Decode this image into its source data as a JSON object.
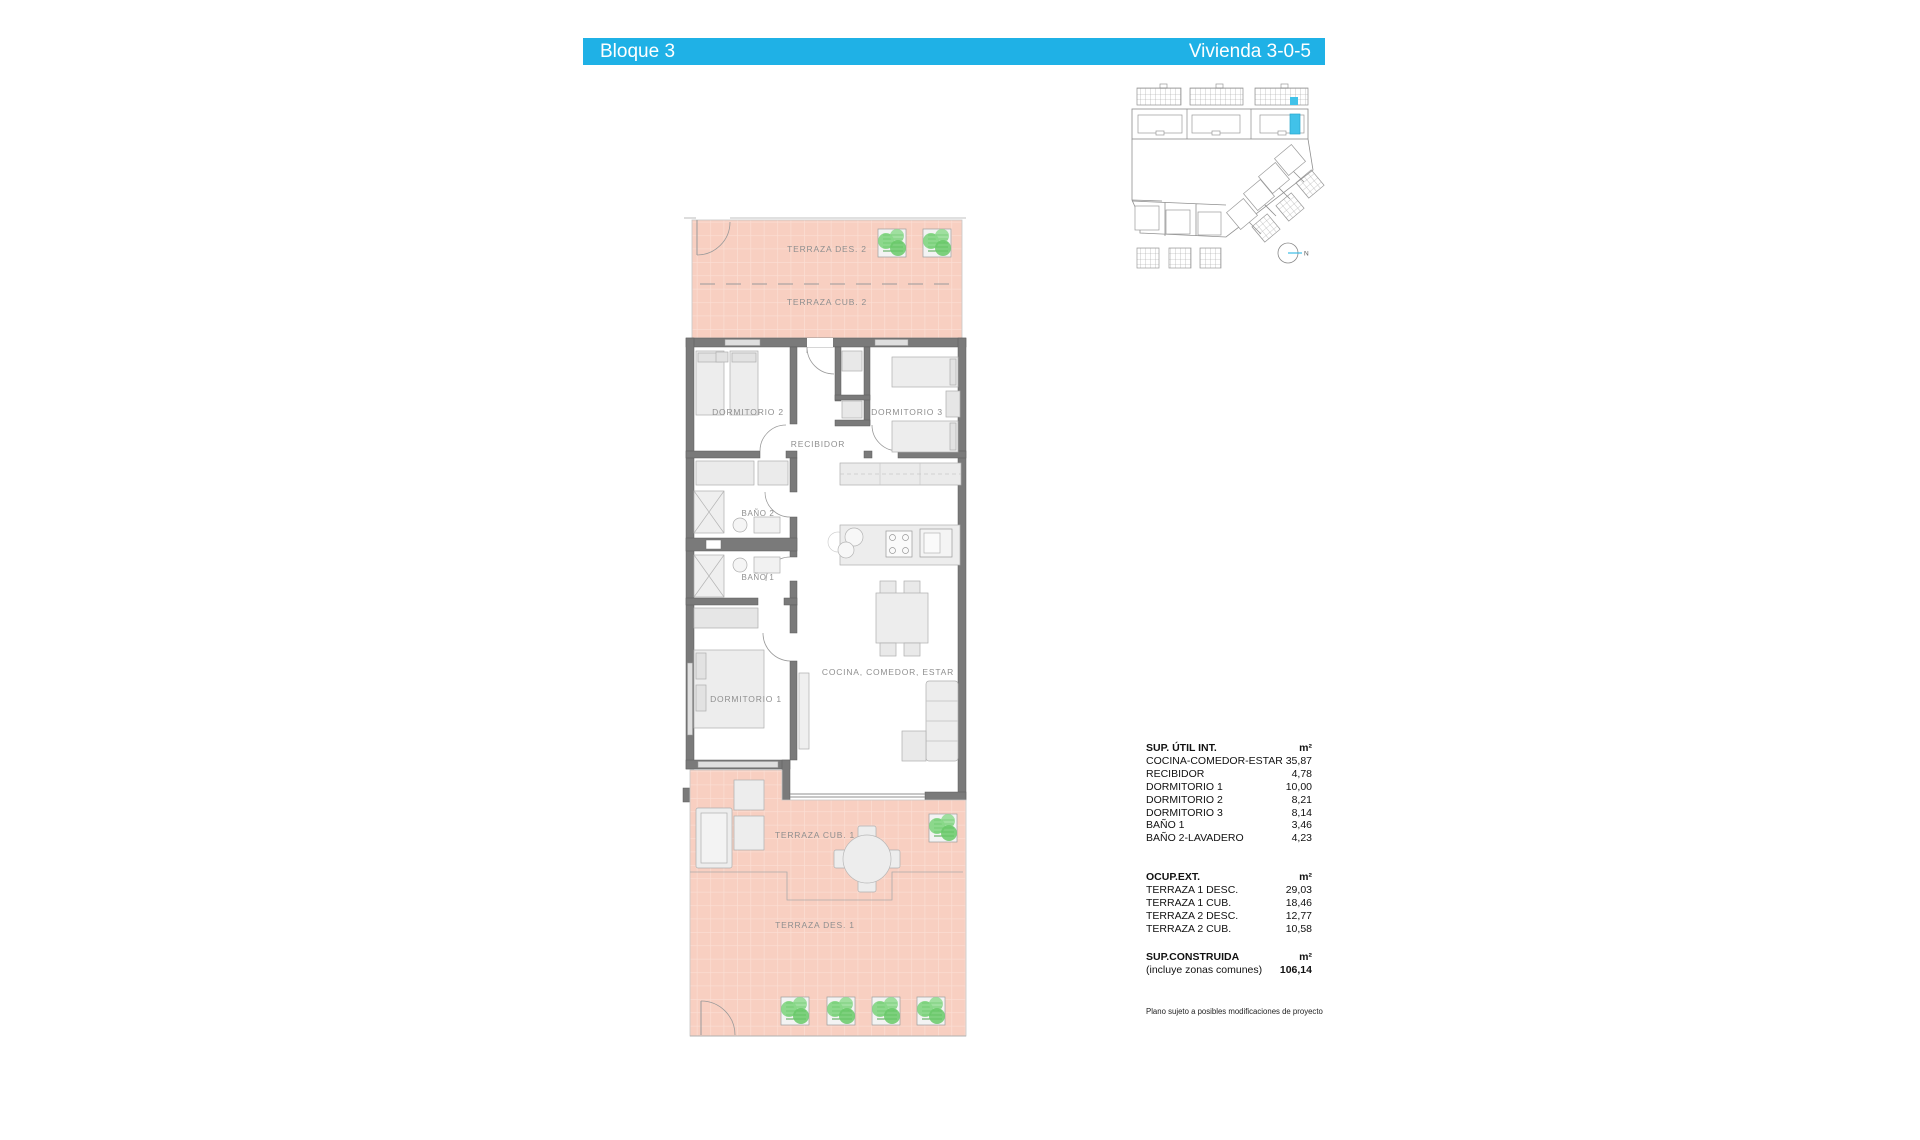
{
  "header": {
    "block_label": "Bloque 3",
    "unit_label": "Vivienda 3-0-5"
  },
  "plan": {
    "labels": {
      "terraza_des_2": "TERRAZA DES. 2",
      "terraza_cub_2": "TERRAZA CUB. 2",
      "dormitorio_2": "DORMITORIO 2",
      "recibidor": "RECIBIDOR",
      "dormitorio_3": "DORMITORIO 3",
      "bano_2": "BAÑO 2",
      "bano_1": "BAÑO 1",
      "dormitorio_1": "DORMITORIO 1",
      "cocina_comedor_estar": "COCINA, COMEDOR, ESTAR",
      "terraza_cub_1": "TERRAZA CUB. 1",
      "terraza_des_1": "TERRAZA DES. 1"
    }
  },
  "site_plan": {
    "north_label": "N"
  },
  "areas_table": {
    "sections": [
      {
        "title": "SUP. ÚTIL INT.",
        "unit": "m²",
        "rows": [
          {
            "label": "COCINA-COMEDOR-ESTAR",
            "value": "35,87"
          },
          {
            "label": "RECIBIDOR",
            "value": "4,78"
          },
          {
            "label": "DORMITORIO 1",
            "value": "10,00"
          },
          {
            "label": "DORMITORIO 2",
            "value": "8,21"
          },
          {
            "label": "DORMITORIO 3",
            "value": "8,14"
          },
          {
            "label": "BAÑO 1",
            "value": "3,46"
          },
          {
            "label": "BAÑO 2-LAVADERO",
            "value": "4,23"
          }
        ]
      },
      {
        "title": "OCUP.EXT.",
        "unit": "m²",
        "rows": [
          {
            "label": "TERRAZA 1 DESC.",
            "value": "29,03"
          },
          {
            "label": "TERRAZA 1 CUB.",
            "value": "18,46"
          },
          {
            "label": "TERRAZA 2 DESC.",
            "value": "12,77"
          },
          {
            "label": "TERRAZA 2 CUB.",
            "value": "10,58"
          }
        ]
      },
      {
        "title": "SUP.CONSTRUIDA",
        "unit": "m²",
        "rows": [
          {
            "label": "(incluye zonas comunes)",
            "value": "106,14"
          }
        ]
      }
    ],
    "disclaimer": "Plano sujeto a posibles modificaciones de proyecto"
  },
  "colors": {
    "accent_cyan": "#1fb1e6",
    "highlight_unit_cyan": "#41c2e9",
    "terrace_tile_pink": "#f8cfc1",
    "wall_gray": "#7a7a7a",
    "plant_green": "#72cf72"
  }
}
